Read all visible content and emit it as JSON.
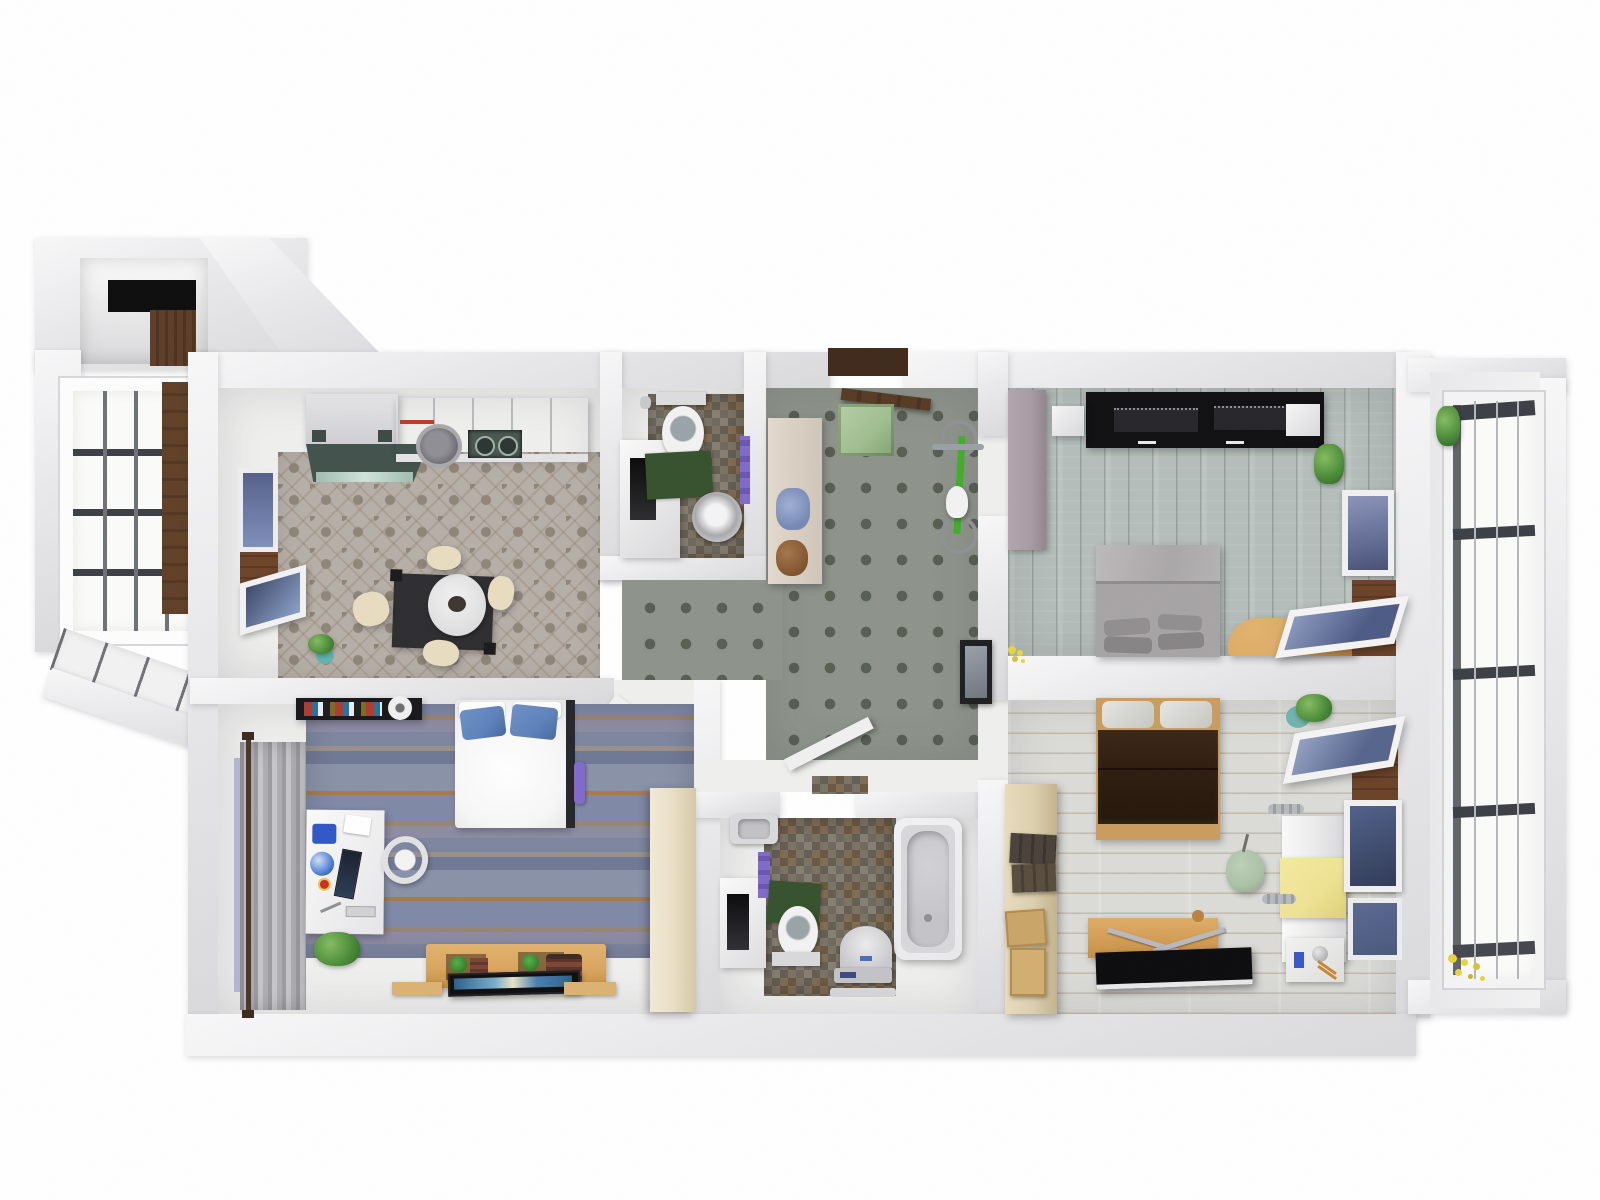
{
  "scene": {
    "kind": "3d-rendered-apartment-floor-plan-top-view",
    "width_px": 1600,
    "height_px": 1200
  },
  "palette": {
    "wall": "#e9e9eb",
    "wallhi": "#f8f8f9",
    "walllo": "#dadadc",
    "floorwhite": "#efefee",
    "tilebase": "#b6afa7",
    "tilemotif": "#8e8478",
    "carpet": "#8d938a",
    "carpetsq": "#565d52",
    "plankteal": "#b4bdb9",
    "plankwhite": "#dbdbd7",
    "slate": "#8289a0",
    "slatebrown": "#a8794e",
    "mosaic": "#7a7263",
    "black": "#121214",
    "oak": "#d9a65f",
    "oakdark": "#b9813f",
    "woodark": "#5d3d28",
    "bedgray": "#a7a4a5",
    "bedwhite": "#f7f7f7",
    "pillowblue": "#5d81ba",
    "bedbrown": "#2e1c10",
    "bedframe": "#c99c5e",
    "cream": "#e7dcc0",
    "beige": "#eadfc6",
    "tan": "#dccfae",
    "mauve": "#a89aa4",
    "matgreen": "#35512c",
    "plantgreen": "#4e8f3a",
    "plantdark": "#2f6b27",
    "purple": "#8069cc",
    "yellow": "#eee292",
    "pouf": "#abc1a6",
    "tub": "#e9e9eb",
    "framedark": "#3b3f45",
    "glass": "#fbfbfa",
    "glassblue": "#66739e",
    "glassdkblue": "#3c4969",
    "tvblue": "#4a7fae",
    "doormat": "#9fbd8f",
    "bike": "#3fae27",
    "hood": "#41514b",
    "hoodglass": "#9fbdb2"
  },
  "rooms": [
    {
      "name": "entry-closet-nook",
      "floor": "dark-wood",
      "furniture": [
        "black-top-cabinet",
        "wood-wardrobe"
      ]
    },
    {
      "name": "bay-window",
      "floor": "white-sill-tiles",
      "furniture": [
        "grid-window",
        "diagonal-sill"
      ]
    },
    {
      "name": "kitchen-dining",
      "floor": "ornamental-tile",
      "furniture": [
        "tall-cabinet",
        "range-hood",
        "upper-cabinet-row",
        "washing-machine",
        "cooktop",
        "dining-table",
        "round-tablecloth",
        "chair",
        "chair",
        "chair",
        "chair",
        "potted-plant",
        "side-window",
        "tilted-open-window",
        "wallpaper-strip"
      ]
    },
    {
      "name": "guest-wc",
      "floor": "mosaic-tile",
      "furniture": [
        "toilet",
        "pedestal-sink",
        "bath-mat-green",
        "towel-purple",
        "niche-half-wall"
      ]
    },
    {
      "name": "entry-hall",
      "floor": "square-pattern-carpet",
      "furniture": [
        "entry-door-open",
        "doormat-green",
        "open-shelf-with-towels",
        "teddy-bear",
        "bicycle-green",
        "wall-mirror",
        "bathroom-door-open"
      ]
    },
    {
      "name": "bedroom-top-right",
      "floor": "teal-wood-planks-vertical",
      "furniture": [
        "black-wardrobe",
        "speaker-box-white",
        "speaker-box-white",
        "mauve-cabinet",
        "double-bed-gray",
        "pillows-gray",
        "wooden-corner-desk",
        "side-window-blue",
        "tilted-open-window",
        "potted-plant",
        "yellow-flowers"
      ]
    },
    {
      "name": "loggia-window-wall",
      "floor": "none",
      "furniture": [
        "full-height-grid-window",
        "plant-top",
        "yellow-flowers-bottom"
      ]
    },
    {
      "name": "bedroom-bottom-left",
      "floor": "slate-strip-stone",
      "furniture": [
        "double-bed-white",
        "pillow-blue",
        "pillow-blue",
        "headboard-dark",
        "bag-purple",
        "wall-book-shelf",
        "paper-roll",
        "office-desk-white",
        "desk-monitor",
        "desk-globe-lamp",
        "desk-chair-white",
        "curtain-gray",
        "curtain-rod",
        "potted-plant",
        "tv-lowboard-oak",
        "flat-tv-screen",
        "speaker-brown",
        "speaker-brown",
        "plant-green-small",
        "plant-green-small",
        "rug-strip-oak",
        "rug-strip-oak",
        "tall-wardrobe-beige"
      ]
    },
    {
      "name": "bathroom",
      "floor": "mosaic-tile",
      "furniture": [
        "bathtub",
        "corner-sink",
        "niche-half-wall",
        "towel-purple",
        "bath-mat-green",
        "toilet",
        "bidet",
        "bathroom-scale"
      ]
    },
    {
      "name": "bedroom-bottom-right",
      "floor": "whitewashed-planks-horizontal",
      "furniture": [
        "double-bed-brown",
        "pillows-white",
        "wardrobe-tan",
        "storage-crates-dark",
        "cardboard-boxes",
        "fold-out-desk-oak",
        "black-desk-panel",
        "metal-arms",
        "pouf-sage",
        "shelf-white",
        "yellow-panel",
        "radiator",
        "radiator",
        "small-desk-items",
        "window-dark-blue",
        "window-dark-blue",
        "tilted-open-window",
        "wood-sill",
        "potted-plant-teal"
      ]
    }
  ]
}
